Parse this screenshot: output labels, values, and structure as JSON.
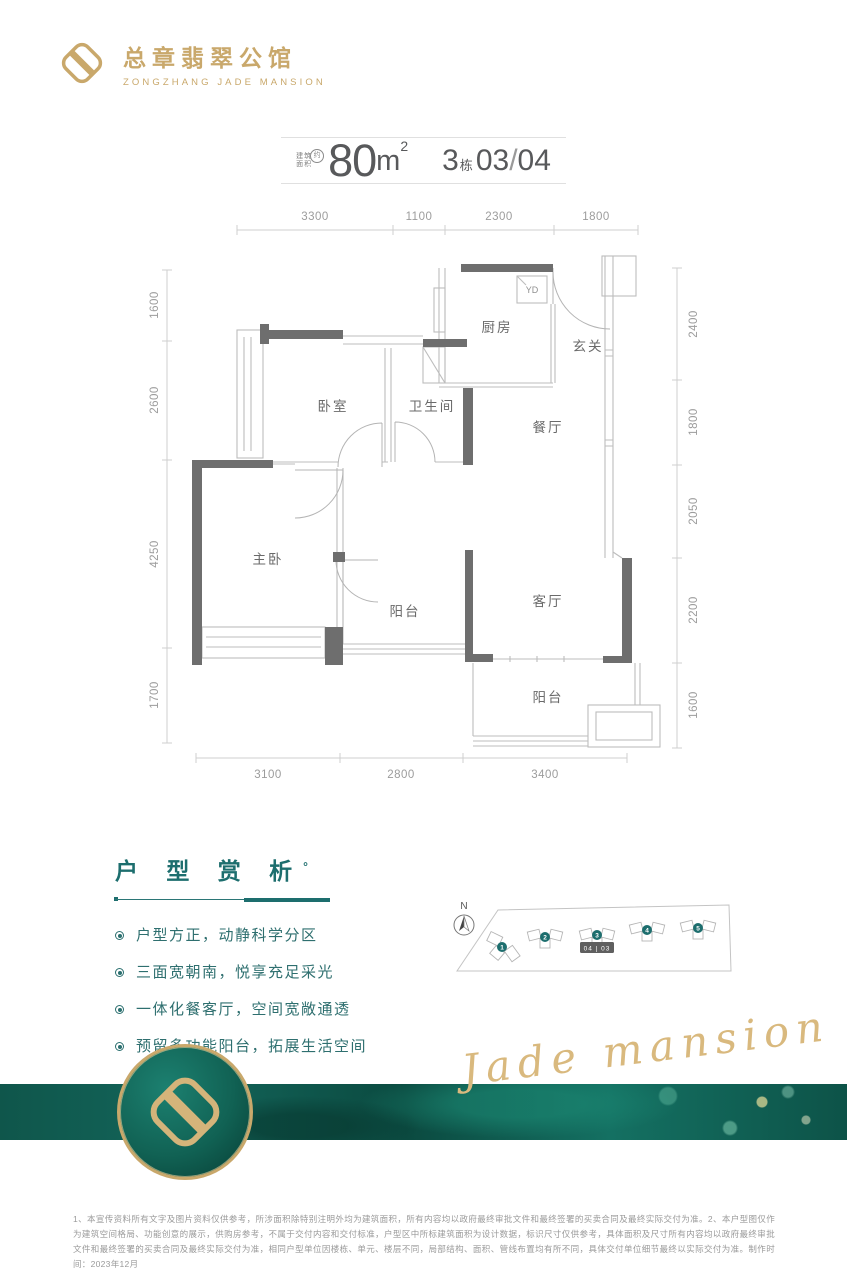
{
  "brand": {
    "cn": "总章翡翠公馆",
    "en": "ZONGZHANG JADE MANSION"
  },
  "title": {
    "area_label_top": "建筑",
    "area_label_bottom": "面积",
    "approx": "约",
    "value": "80",
    "unit": "m",
    "sup": "2",
    "block_value": "3",
    "block_unit": "栋",
    "unit_left": "03",
    "unit_slash": "/",
    "unit_right": "04"
  },
  "plan": {
    "dims_top": [
      "3300",
      "1100",
      "2300",
      "1800"
    ],
    "dims_left": [
      "1600",
      "2600",
      "4250",
      "1700"
    ],
    "dims_right": [
      "2400",
      "1800",
      "2050",
      "2200",
      "1600"
    ],
    "dims_bottom": [
      "3100",
      "2800",
      "3400"
    ],
    "rooms": {
      "kitchen": "厨房",
      "foyer": "玄关",
      "bedroom": "卧室",
      "bathroom": "卫生间",
      "dining": "餐厅",
      "master": "主卧",
      "balcony_mid": "阳台",
      "living": "客厅",
      "balcony_bottom": "阳台",
      "duct": "YD"
    }
  },
  "analysis": {
    "title": "户 型 赏 析",
    "degree": "°",
    "bullets": [
      "户型方正，动静科学分区",
      "三面宽朝南，悦享充足采光",
      "一体化餐客厅，空间宽敞通透",
      "预留多功能阳台，拓展生活空间"
    ]
  },
  "siteplan": {
    "north": "N",
    "buildings": [
      "1",
      "2",
      "3",
      "4",
      "5"
    ],
    "badge": "04 | 03"
  },
  "band": {
    "script": "Jade mansion"
  },
  "footer": {
    "disclaimer": "1、本宣传资料所有文字及图片资料仅供参考，所涉面积除特别注明外均为建筑面积，所有内容均以政府最终审批文件和最终签署的买卖合同及最终实际交付为准。2、本户型图仅作为建筑空间格局、功能创意的展示，供购房参考，不属于交付内容和交付标准，户型区中所标建筑面积为设计数据，标识尺寸仅供参考，具体面积及尺寸所有内容均以政府最终审批文件和最终签署的买卖合同及最终实际交付为准，相同户型单位因楼栋、单元、楼层不同，局部结构、面积、管线布置均有所不同，具体交付单位细节最终以实际交付为准。制作时间：2023年12月"
  },
  "colors": {
    "gold": "#c9a86b",
    "teal": "#1d6e6e",
    "wall": "#6e6e6e",
    "jade_band": "#0b4a40"
  }
}
